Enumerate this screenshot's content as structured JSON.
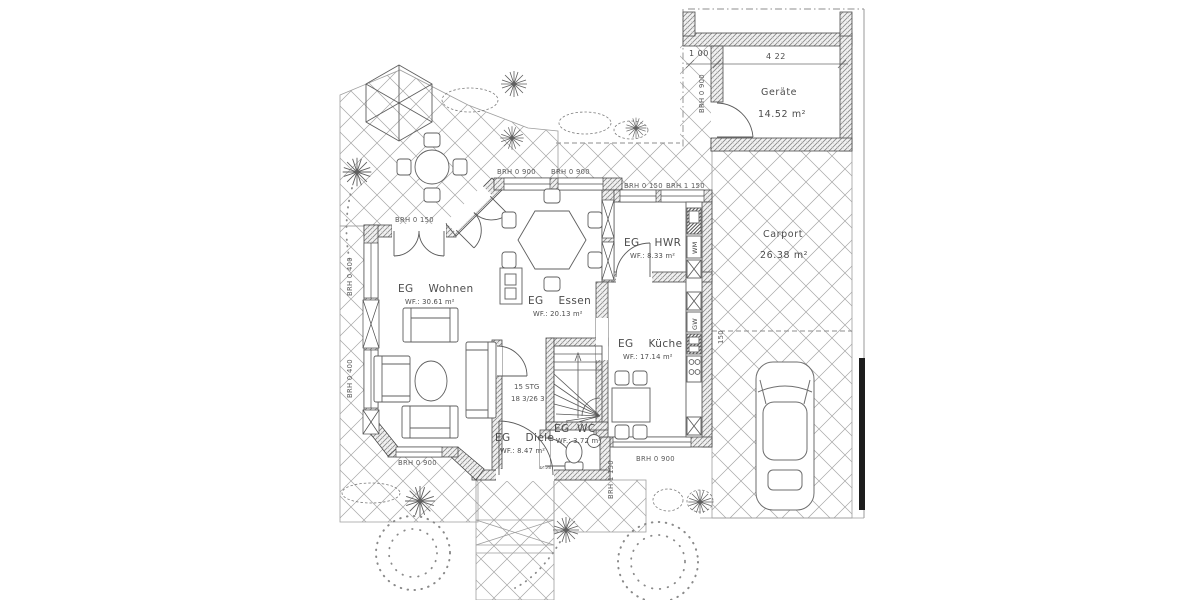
{
  "page": {
    "background": "#ffffff"
  },
  "plan": {
    "rooms": {
      "wohnen": {
        "name": "EG    Wohnen",
        "area": "WF.: 30.61 m²"
      },
      "essen": {
        "name": "EG    Essen",
        "area": "WF.: 20.13 m²"
      },
      "hwr": {
        "name": "EG    HWR",
        "area": "WF.: 8.33 m²"
      },
      "kueche": {
        "name": "EG    Küche",
        "area": "WF.: 17.14 m²"
      },
      "diele": {
        "name": "EG    Diele",
        "area": "WF.: 8.47 m²"
      },
      "wc": {
        "name": "EG  WC",
        "area": "WF.: 3.72 m²"
      },
      "geraete": {
        "name": "Geräte",
        "area": "14.52 m²"
      },
      "carport": {
        "name": "Carport",
        "area": "26.38 m²"
      }
    },
    "stairs": {
      "line1": "15 STG",
      "line2": "18 3/26 3"
    },
    "appliances": {
      "washing_machine": "WM",
      "dishwasher": "GW"
    },
    "dimensions": {
      "strip": "1 00",
      "shed_width": "4 22",
      "carport_mark": "150"
    },
    "parapets": {
      "terrace_door": "BRH 0 150",
      "dining_left": "BRH 0 900",
      "dining_right": "BRH 0 900",
      "hwr_left": "BRH 0 150",
      "hwr_right": "BRH 1 150",
      "living_upper": "BRH 0 400",
      "living_lower": "BRH 0 400",
      "living_south": "BRH 0 900",
      "kitchen_south": "BRH 0 900",
      "wc_east": "BRH 1 150",
      "shed_west": "BRH 0 900"
    },
    "colors": {
      "wall_line": "#4a4a4a",
      "paving_line": "#9a9a9a",
      "label": "#4c4c4c",
      "boundary": "#8c8c8c"
    }
  }
}
